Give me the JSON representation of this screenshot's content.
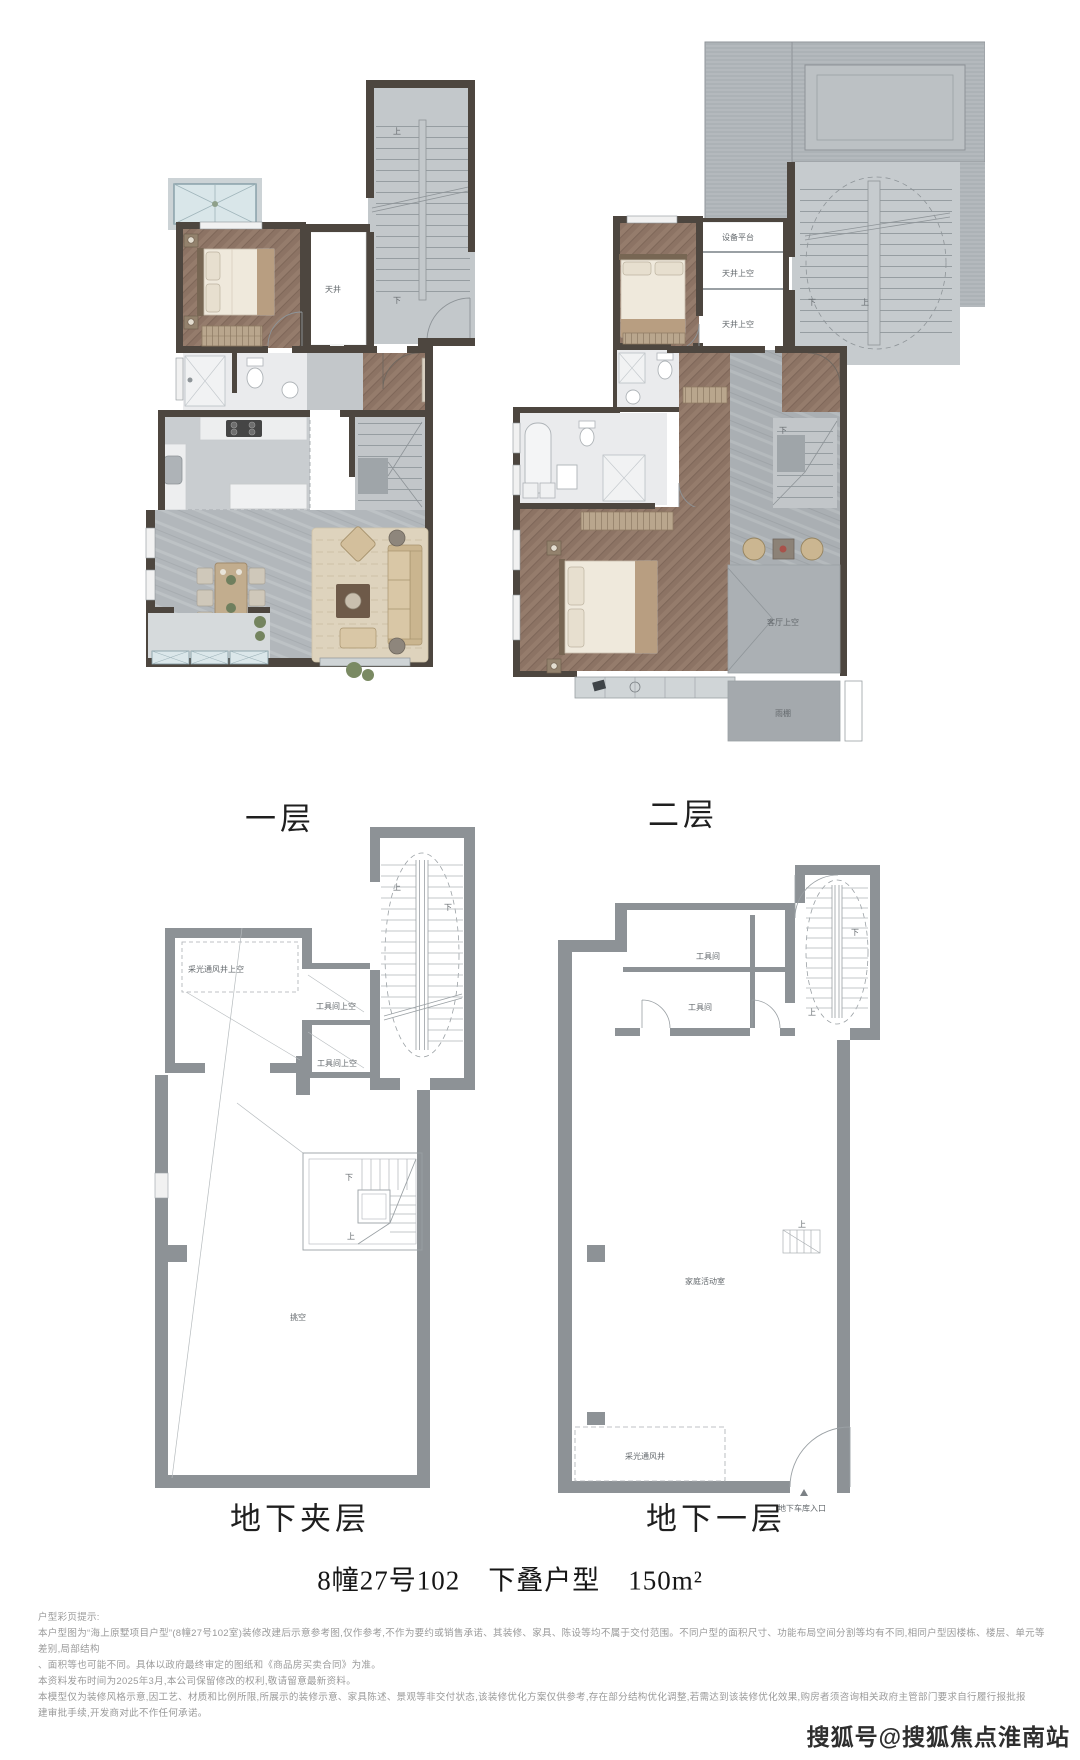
{
  "sheet": {
    "title": "8幢27号102　下叠户型　150m²",
    "watermark": "搜狐号@搜狐焦点淮南站"
  },
  "plans": {
    "floor1": {
      "name": "一层",
      "labels": {
        "lightwell": "天井",
        "up": "上",
        "down": "下"
      }
    },
    "floor2": {
      "name": "二层",
      "labels": {
        "equip_platform": "设备平台",
        "lightwell_above_1": "天井上空",
        "lightwell_above_2": "天井上空",
        "living_above": "客厅上空",
        "canopy": "雨棚",
        "up": "上",
        "down": "下"
      }
    },
    "mezz": {
      "name": "地下夹层",
      "labels": {
        "shaft_above": "采光通风井上空",
        "tool_above_1": "工具间上空",
        "tool_above_2": "工具间上空",
        "void": "挑空",
        "up": "上",
        "down": "下"
      }
    },
    "b1": {
      "name": "地下一层",
      "labels": {
        "tool_1": "工具间",
        "tool_2": "工具间",
        "family_room": "家庭活动室",
        "shaft": "采光通风井",
        "garage_entry": "地下车库入口",
        "up": "上",
        "down": "下"
      }
    }
  },
  "disclaimer": {
    "heading": "户型彩页提示:",
    "lines": [
      "本户型图为“海上原墅项目户型”(8幢27号102室)装修改建后示意参考图,仅作参考,不作为要约或销售承诺、其装修、家具、陈设等均不属于交付范围。不同户型的面积尺寸、功能布局空间分割等均有不同,相同户型因楼栋、楼层、单元等差别,局部结构",
      "、面积等也可能不同。具体以政府最终审定的图纸和《商品房买卖合同》为准。",
      "本资料发布时间为2025年3月,本公司保留修改的权利,敬请留意最新资料。",
      "本模型仅为装修风格示意,因工艺、材质和比例所限,所展示的装修示意、家具陈述、景观等非交付状态,该装修优化方案仅供参考,存在部分结构优化调整,若需达到该装修优化效果,购房者须咨询相关政府主管部门要求自行履行报批报",
      "建审批手续,开发商对此不作任何承诺。"
    ]
  }
}
